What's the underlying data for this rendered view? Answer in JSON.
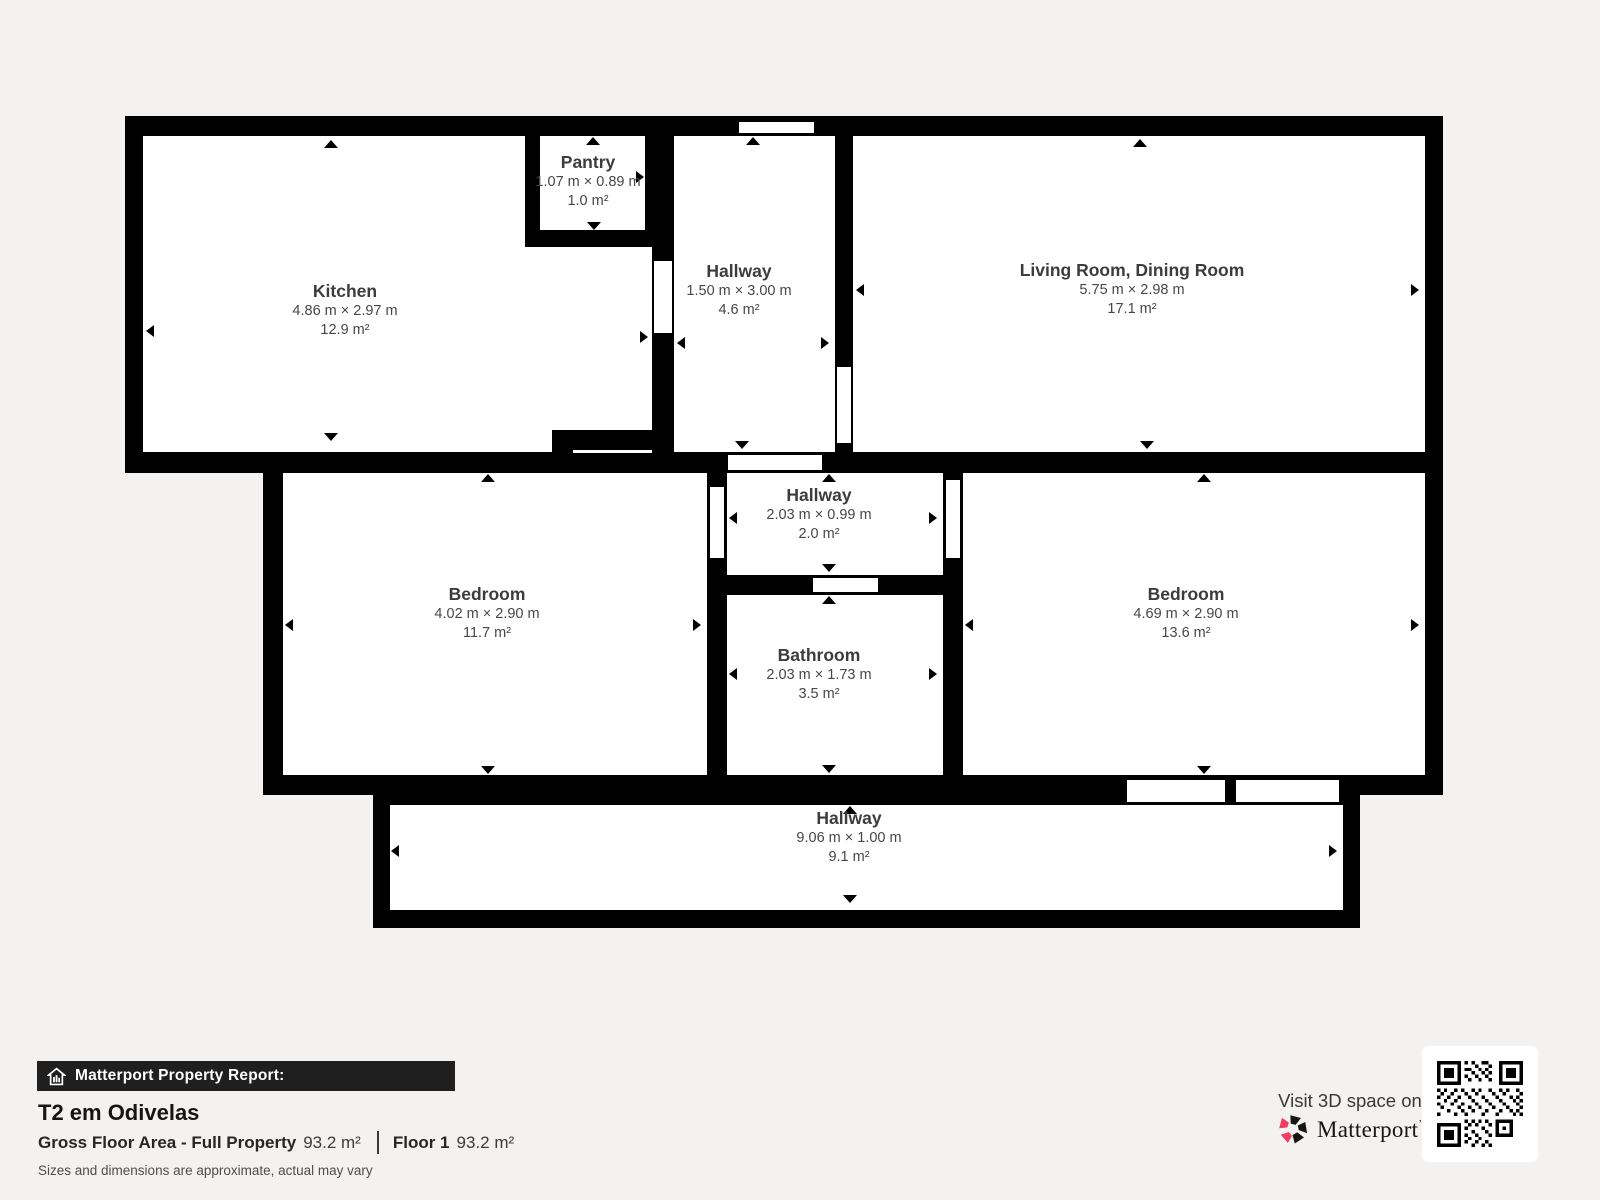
{
  "page": {
    "background": "#f3f2f0"
  },
  "floorplan": {
    "wall_color": "#000000",
    "room_fill": "#ffffff",
    "rooms": [
      {
        "id": "kitchen",
        "name": "Kitchen",
        "size": "4.86 m × 2.97 m",
        "area": "12.9 m²"
      },
      {
        "id": "pantry",
        "name": "Pantry",
        "size": "1.07 m × 0.89 m",
        "area": "1.0 m²"
      },
      {
        "id": "hallway-top",
        "name": "Hallway",
        "size": "1.50 m × 3.00 m",
        "area": "4.6 m²"
      },
      {
        "id": "living-dining",
        "name": "Living Room, Dining Room",
        "size": "5.75 m × 2.98 m",
        "area": "17.1 m²"
      },
      {
        "id": "hallway-middle",
        "name": "Hallway",
        "size": "2.03 m × 0.99 m",
        "area": "2.0 m²"
      },
      {
        "id": "bedroom-left",
        "name": "Bedroom",
        "size": "4.02 m × 2.90 m",
        "area": "11.7 m²"
      },
      {
        "id": "bathroom",
        "name": "Bathroom",
        "size": "2.03 m × 1.73 m",
        "area": "3.5 m²"
      },
      {
        "id": "bedroom-right",
        "name": "Bedroom",
        "size": "4.69 m × 2.90 m",
        "area": "13.6 m²"
      },
      {
        "id": "hallway-bottom",
        "name": "Hallway",
        "size": "9.06 m × 1.00 m",
        "area": "9.1 m²"
      }
    ]
  },
  "footer": {
    "report_label": "Matterport Property Report:",
    "property_title": "T2 em Odivelas",
    "gfa_label": "Gross Floor Area - Full Property",
    "gfa_value": "93.2 m²",
    "floor_label": "Floor 1",
    "floor_value": "93.2 m²",
    "disclaimer": "Sizes and dimensions are approximate, actual may vary"
  },
  "cta": {
    "visit_text": "Visit 3D space on",
    "brand": "Matterport",
    "brand_mark": "ʼ"
  },
  "colors": {
    "accent": "#f13d5c",
    "bar_bg": "#1f1f1f",
    "wall": "#000000"
  }
}
